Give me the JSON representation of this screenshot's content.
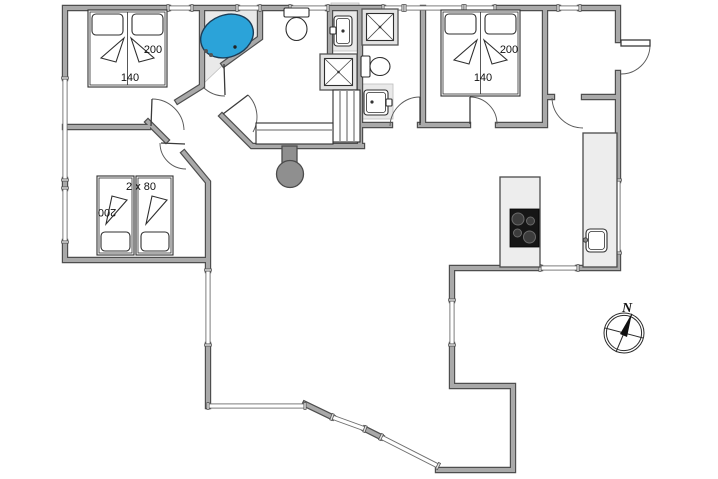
{
  "labels": {
    "bedroom_top_left": {
      "bed_length": "200",
      "bed_width": "140"
    },
    "bedroom_top_right": {
      "bed_length": "200",
      "bed_width": "140"
    },
    "bedroom_left": {
      "beds": "2 x 80",
      "bed_length": "200"
    },
    "compass": {
      "north": "N"
    }
  },
  "colors": {
    "wall": "#a9a9a9",
    "wall_outline": "#4e4e4e",
    "bathtub": "#2ba3d9",
    "fixture_floor": "#e9e9e9",
    "cooktop": "#161616",
    "fireplace": "#8f8f8f"
  },
  "icons": {
    "bathtub": "corner whirlpool tub",
    "toilet": "toilet with cistern",
    "shower": "square shower tray with X",
    "washbasin": "small basin with tap",
    "cooktop": "4-burner hob",
    "fireplace": "round wood stove",
    "compass": "north arrow"
  }
}
